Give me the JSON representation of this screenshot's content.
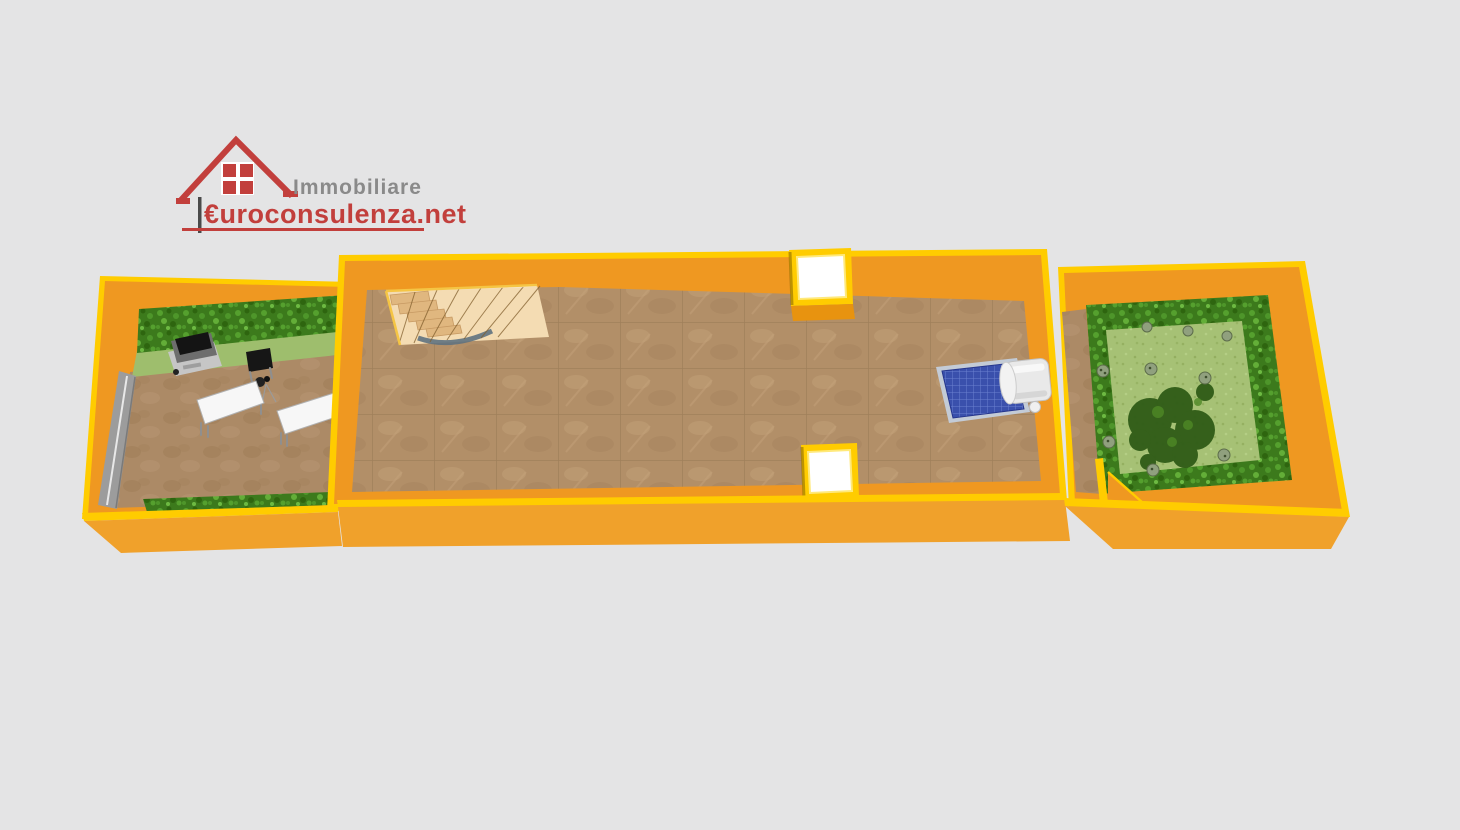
{
  "logo": {
    "brand_top": "Immobiliare",
    "brand_bottom": "€uroconsulenza.net"
  },
  "colors": {
    "background": "#e4e4e5",
    "wall-orange": "#ef9821",
    "wall-front": "#f0a12b",
    "wall-cap": "#ffcc00",
    "floor-tile": "#b28f68",
    "dirt": "#ac8a66",
    "grass-light": "#9ebe6d",
    "hedge-green": "#3c7a1c",
    "lawn-green": "#a6c175",
    "stair-floor": "#f4dcb3",
    "stair-step": "#e0b77f",
    "driveway-gray": "#9c9c9c",
    "panel-blue": "#3a50ac",
    "tank-white": "#e9e9e9",
    "skylight-white": "#ffffff",
    "table-white": "#f7f7f7",
    "grill-dark": "#6e6e6e",
    "tree-green": "#2f5b17",
    "logo-red": "#c23f3c",
    "logo-gray": "#8a8a8a"
  },
  "scene": {
    "type": "3d-floorplan-render",
    "objects": [
      {
        "name": "left-courtyard",
        "features": [
          "top-hedge",
          "grass-strip",
          "tiled-ground",
          "gray-driveway",
          "barbecue-grill",
          "small-black-desk",
          "two-white-tables",
          "bottom-hedge"
        ]
      },
      {
        "name": "main-hall",
        "features": [
          "brown-tiled-floor",
          "spiral-staircase",
          "skylight-top",
          "skylight-bottom",
          "solar-water-heater"
        ]
      },
      {
        "name": "right-garden",
        "features": [
          "brown-path",
          "perimeter-hedge",
          "lawn",
          "central-tree",
          "small-bushes",
          "interior-wall-stub"
        ]
      }
    ]
  }
}
